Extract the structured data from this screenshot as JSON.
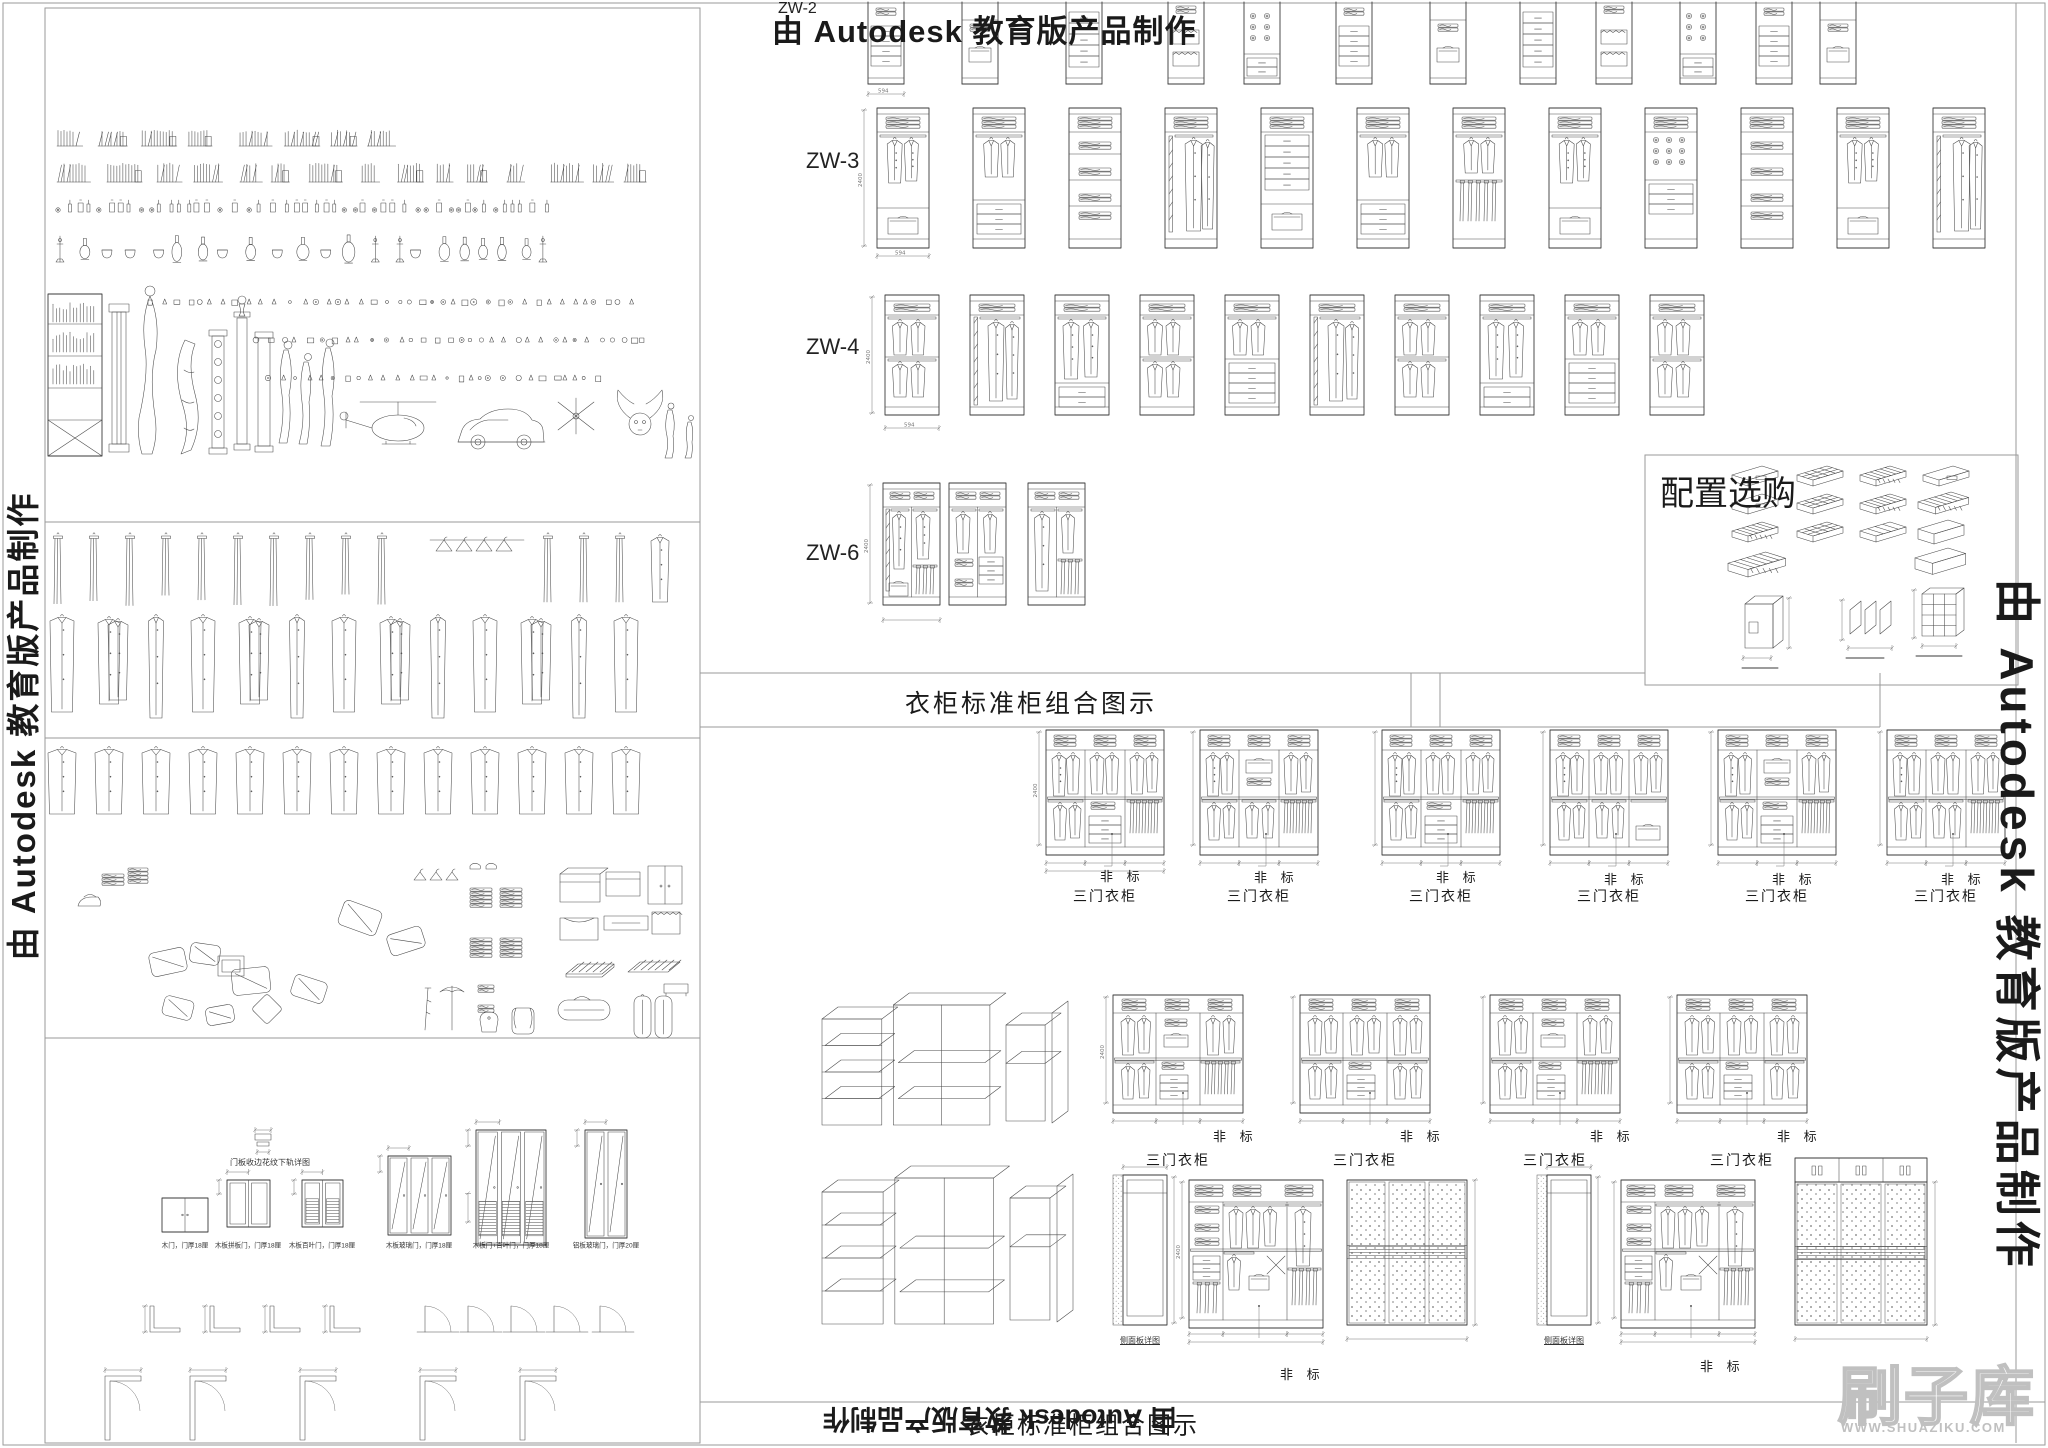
{
  "page": {
    "title_top": "由 Autodesk 教育版产品制作",
    "title_left_vertical": "由 Autodesk 教育版产品制作",
    "title_right_vertical": "由 Autodesk 教育版产品制作",
    "title_bottom_flipped": "由 Autodesk 教育版产品制作",
    "section_title": "衣柜标准柜组合图示",
    "section_title_bottom": "衣柜标准柜组合图示"
  },
  "row_labels": {
    "zw2": "ZW-2",
    "zw3": "ZW-3",
    "zw4": "ZW-4",
    "zw6": "ZW-6"
  },
  "config_box": {
    "title": "配置选购"
  },
  "callouts": {
    "nonstandard": "非 标"
  },
  "unit_labels": {
    "three_door": "三门衣柜",
    "side_panel_detail": "侧面板详图",
    "door_track_detail": "门板收边花纹下轨详图"
  },
  "dims": {
    "height": "2400",
    "width": "594"
  },
  "door_labels": [
    "木门，门厚18厘",
    "木板拼板门，门厚18厘",
    "木板百叶门，门厚18厘",
    "木板玻璃门，门厚18厘",
    "木板门+百叶门，门厚18厘",
    "铝板玻璃门，门厚20厘"
  ],
  "watermark": {
    "text": "刷子库",
    "url": "WWW.SHUAZIKU.COM"
  },
  "counts": {
    "zw2_units": 12,
    "zw3_units": 12,
    "zw4_units": 10,
    "zw6_units": 3,
    "combo_row1": 6,
    "combo_row2": 4
  },
  "colors": {
    "line": "#3a3a3a",
    "thin": "#4a4a4a",
    "dim": "#777777",
    "border": "#9a9a9a",
    "text": "#1a1a1a",
    "watermark": "#c0c0c0",
    "bg": "#ffffff"
  }
}
